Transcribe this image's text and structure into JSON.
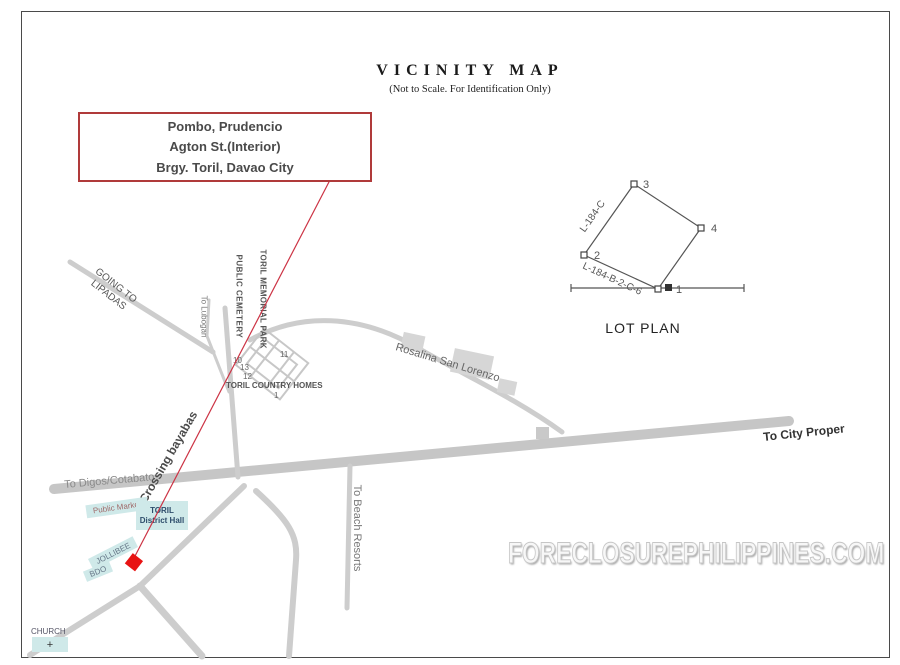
{
  "title": "VICINITY MAP",
  "subtitle": "(Not to Scale. For Identification Only)",
  "callout": {
    "line1": "Pombo, Prudencio",
    "line2": "Agton St.(Interior)",
    "line3": "Brgy. Toril, Davao City"
  },
  "lot_plan": {
    "title": "LOT PLAN",
    "corners": {
      "c1": "1",
      "c2": "2",
      "c3": "3",
      "c4": "4"
    },
    "edge_left": "L-184-C",
    "edge_bottom": "L-184-B-2-C-6"
  },
  "roads": {
    "to_city_proper": "To City Proper",
    "to_digos": "To Digos/Cotabato",
    "crossing_bayabas": "Crossing bayabas",
    "to_beach_resorts": "To Beach Resorts",
    "to_lubogan": "To Lubogan",
    "going_to_line1": "GOING TO",
    "going_to_line2": "LIPADAS",
    "rosalina": "Rosalina San Lorenzo"
  },
  "areas": {
    "public_cemetery": "PUBLIC CEMETERY",
    "toril_memorial_park": "TORIL MEMORIAL PARK",
    "subdivision_name": "TORIL COUNTRY HOMES",
    "block_numbers": {
      "n10": "10",
      "n13": "13",
      "n12": "12",
      "n11": "11",
      "n1": "1"
    }
  },
  "landmarks": {
    "public_market": "Public Market",
    "toril_hall_line1": "TORIL",
    "toril_hall_line2": "District Hall",
    "jollibee": "JOLLIBEE",
    "bdo": "BDO",
    "church": "CHURCH",
    "church_cross": "+"
  },
  "watermark": "FORECLOSUREPHILIPPINES.COM",
  "colors": {
    "callout_red": "#b03a3a",
    "line_red": "#cc3344",
    "marker_red": "#e81313",
    "road_gray": "#cdcdcd",
    "teal_fill": "#cfe9e9"
  }
}
